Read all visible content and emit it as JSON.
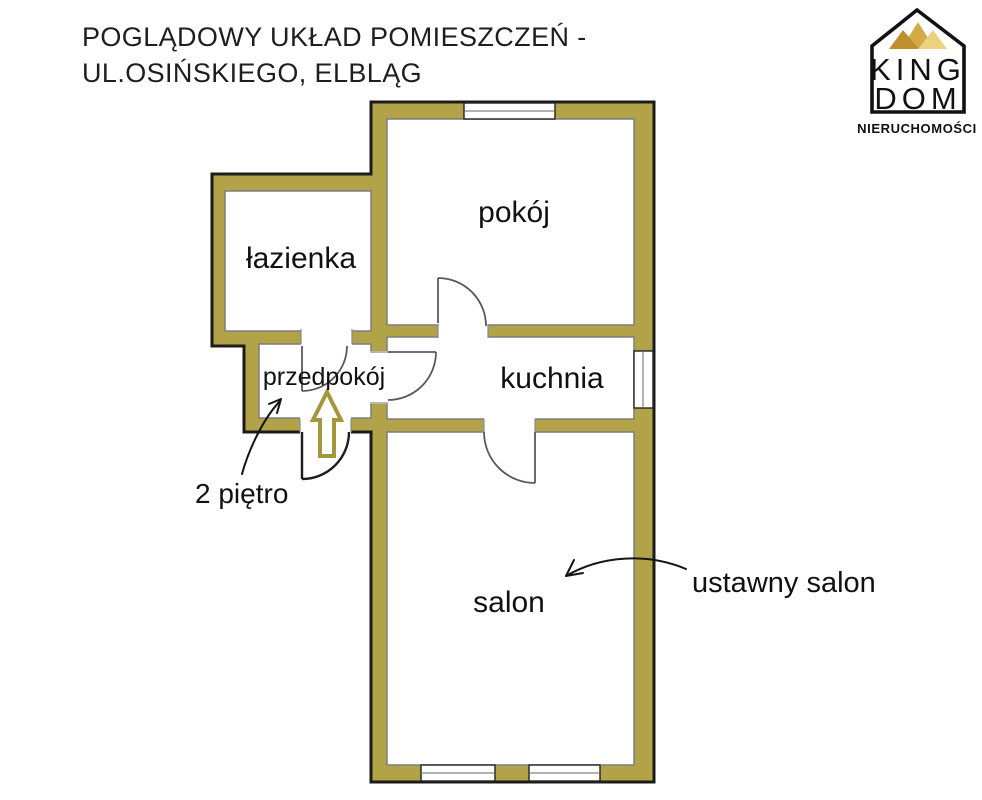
{
  "title": {
    "line1": "POGLĄDOWY UKŁAD POMIESZCZEŃ -",
    "line2": "UL.OSIŃSKIEGO, ELBLĄG"
  },
  "logo": {
    "brand_top": "KING",
    "brand_bottom": "DOM",
    "tagline": "NIERUCHOMOŚCI",
    "crown_colors": {
      "left": "#bf8e2d",
      "middle": "#d5a945",
      "right": "#ead27f"
    }
  },
  "floor_plan": {
    "rooms": [
      {
        "id": "lazienka",
        "label": "łazienka"
      },
      {
        "id": "pokoj",
        "label": "pokój"
      },
      {
        "id": "przedpokoj",
        "label": "przedpokój"
      },
      {
        "id": "kuchnia",
        "label": "kuchnia"
      },
      {
        "id": "salon",
        "label": "salon"
      }
    ],
    "annotations": [
      {
        "id": "floor-note",
        "label": "2 piętro"
      },
      {
        "id": "salon-note",
        "label": "ustawny salon"
      }
    ],
    "colors": {
      "wall_fill": "#b2a348",
      "wall_outline": "#1b1b1b",
      "room_line": "#7d7d7d",
      "door_line": "#5a5a5a",
      "entrance_door_line": "#1d1d1d",
      "entrance_arrow": "#a4973b"
    }
  }
}
